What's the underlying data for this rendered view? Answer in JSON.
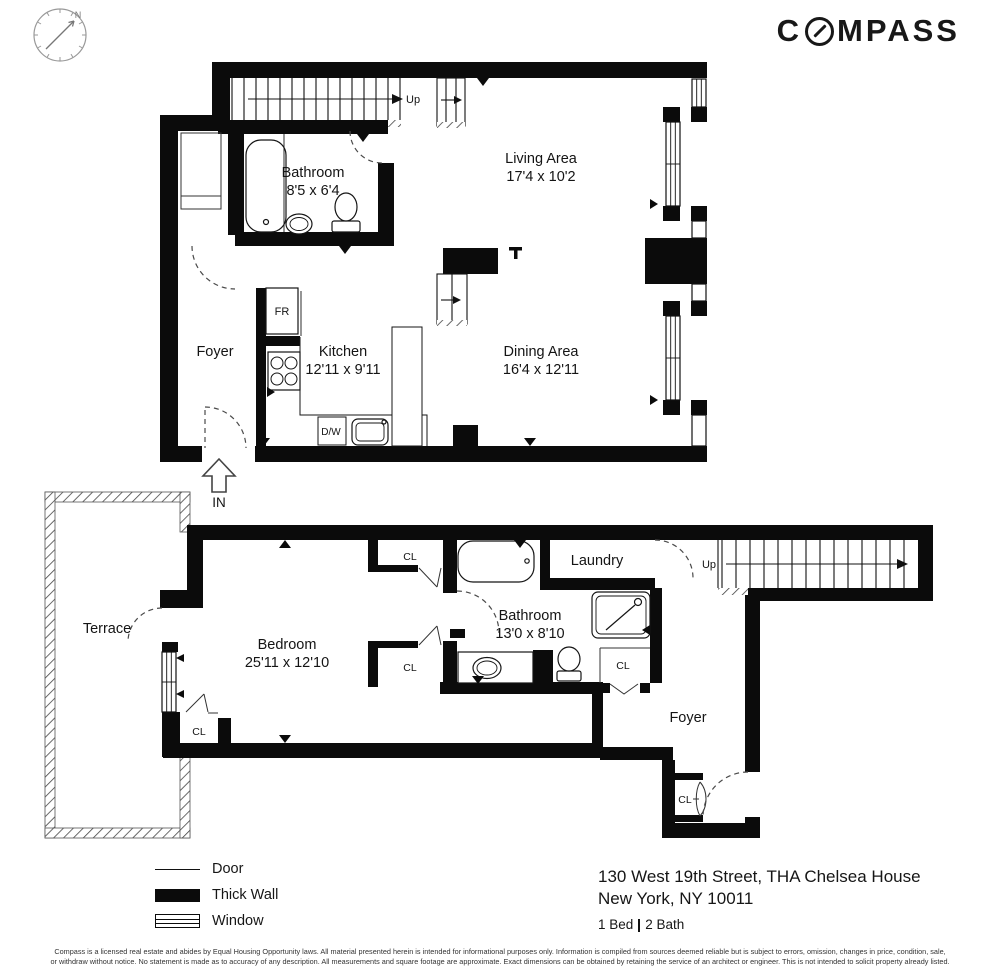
{
  "brand": {
    "logo_prefix": "C",
    "logo_suffix": "MPASS"
  },
  "compass_rose": {
    "north_label": "N"
  },
  "floors": {
    "upper": {
      "stair_label": "Up",
      "entry_label": "IN",
      "rooms": {
        "bathroom": {
          "name": "Bathroom",
          "dims": "8'5 x 6'4"
        },
        "living": {
          "name": "Living Area",
          "dims": "17'4 x 10'2"
        },
        "foyer": {
          "name": "Foyer"
        },
        "kitchen": {
          "name": "Kitchen",
          "dims": "12'11 x 9'11"
        },
        "dining": {
          "name": "Dining Area",
          "dims": "16'4 x 12'11"
        }
      },
      "appliances": {
        "fridge": "FR",
        "dishwasher": "D/W"
      }
    },
    "lower": {
      "stair_label": "Up",
      "closet_label": "CL",
      "rooms": {
        "terrace": {
          "name": "Terrace"
        },
        "bedroom": {
          "name": "Bedroom",
          "dims": "25'11 x 12'10"
        },
        "bathroom": {
          "name": "Bathroom",
          "dims": "13'0 x 8'10"
        },
        "laundry": {
          "name": "Laundry"
        },
        "foyer": {
          "name": "Foyer"
        }
      }
    }
  },
  "legend": {
    "items": [
      {
        "label": "Door"
      },
      {
        "label": "Thick Wall"
      },
      {
        "label": "Window"
      }
    ]
  },
  "property": {
    "address_line1": "130 West 19th Street, THA  Chelsea House",
    "address_line2": "New York, NY 10011",
    "beds": "1 Bed",
    "baths": "2 Bath"
  },
  "disclaimer": {
    "line1": "Compass is a licensed real estate and abides by Equal Housing Opportunity laws. All material presented herein is intended for informational purposes only. Information is compiled from sources deemed reliable but is subject to errors, omission, changes in price, condition, sale,",
    "line2": "or withdraw without notice. No statement is made as to accuracy of any description. All measurements and square footage are approximate. Exact dimensions can be obtained by retaining the service of an architect or engineer. This is not intended to solicit property already listed."
  }
}
